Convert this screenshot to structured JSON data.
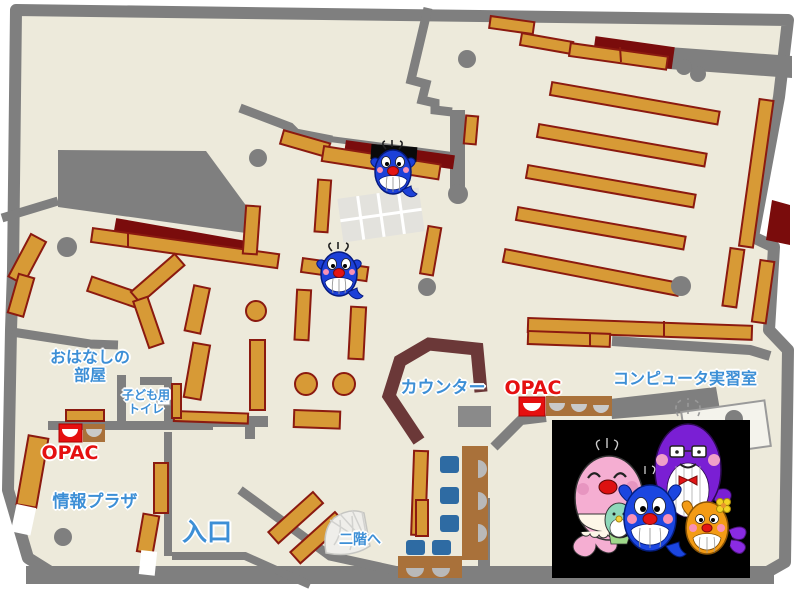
{
  "map": {
    "rooms": {
      "storytelling_room": {
        "line1": "おはなしの",
        "line2": "部屋"
      },
      "kids_toilet": {
        "line1": "子ども用",
        "line2": "トイレ"
      },
      "opac_left": {
        "label": "OPAC"
      },
      "info_plaza": {
        "label": "情報プラザ"
      },
      "entrance": {
        "label": "入口"
      },
      "counter": {
        "label": "カウンター"
      },
      "opac_right": {
        "label": "OPAC"
      },
      "computer_room": {
        "label": "コンピュータ実習室"
      },
      "stairs_up": {
        "label": "二階へ"
      }
    },
    "colors": {
      "floor": "#edeadb",
      "wall": "#7f7f7f",
      "shelf": "#d79a36",
      "shelf_border": "#8b1a10",
      "dark_red": "#7a0c0c",
      "counter": "#6b3838",
      "label_blue": "#3d8fd6",
      "opac_red": "#e51010",
      "chair_blue": "#2e6ba3",
      "table_brown": "#a9713a",
      "photo_bg": "#000000",
      "mascot_blue": "#1c40d8",
      "mascot_pink": "#f5aed2",
      "mascot_purple": "#7a1fd4",
      "mascot_orange": "#f39b15"
    }
  }
}
